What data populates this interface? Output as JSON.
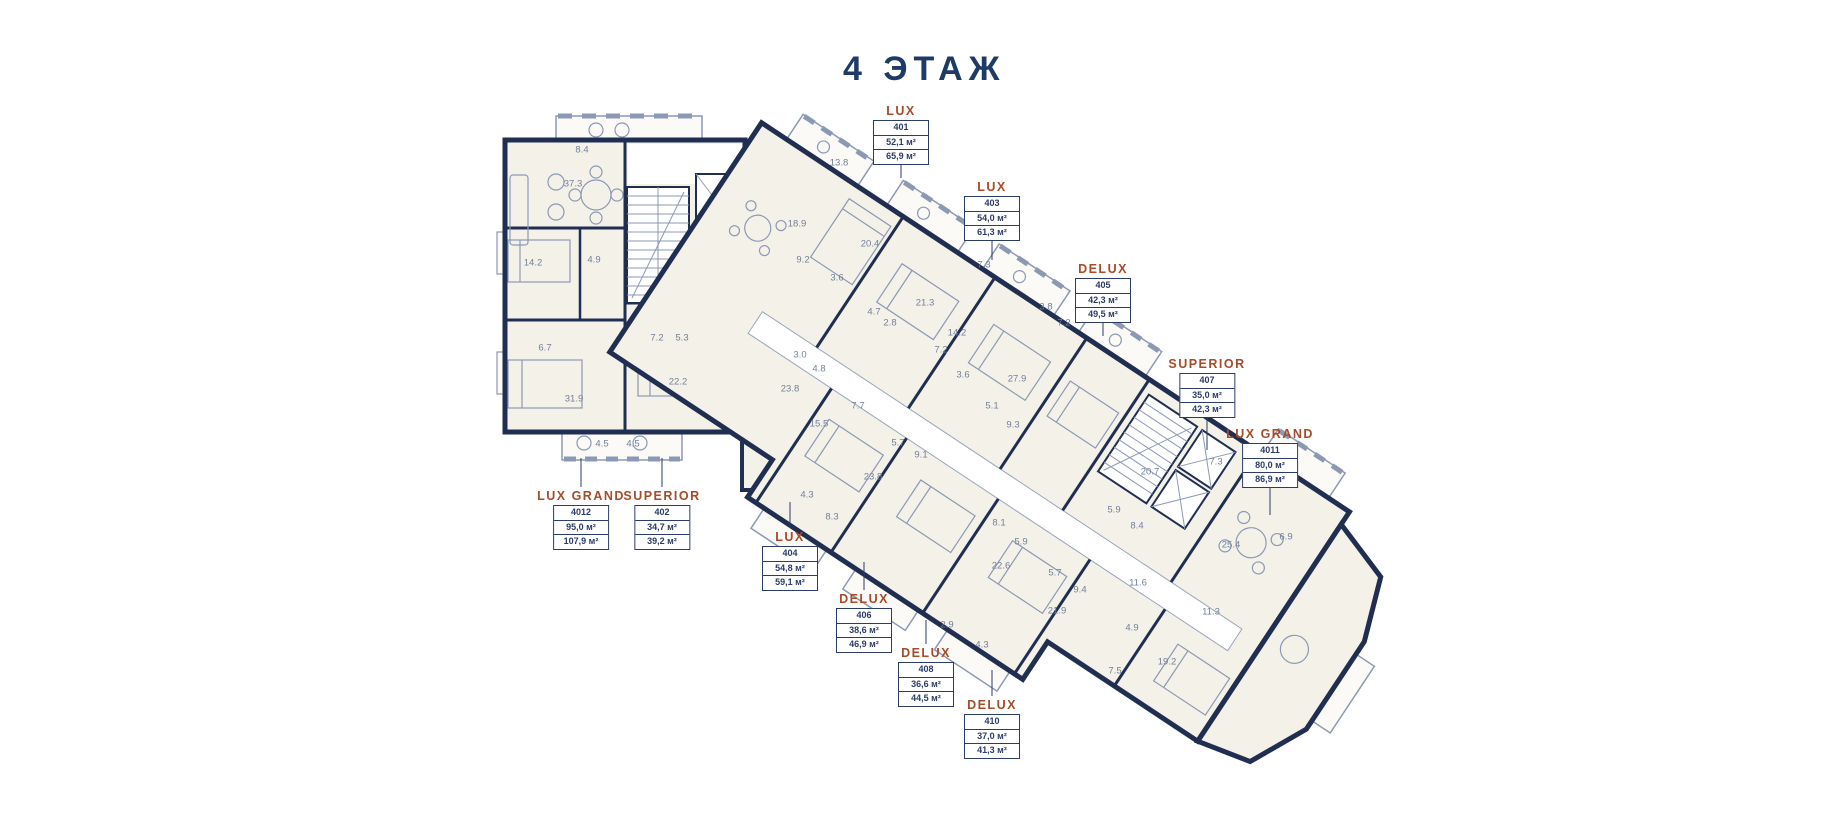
{
  "title": "4 ЭТАЖ",
  "colors": {
    "wall": "#202e52",
    "floor": "#f4f1e9",
    "corridor": "#ffffff",
    "furniture": "#8c99b5",
    "accent_unit_type": "#a74b28",
    "callout_text": "#2c3c68",
    "room_number_text": "#72809b",
    "title_text": "#1d3b66"
  },
  "units": [
    {
      "type": "LUX",
      "number": "401",
      "area1": "52,1 м²",
      "area2": "65,9 м²"
    },
    {
      "type": "LUX",
      "number": "403",
      "area1": "54,0 м²",
      "area2": "61,3 м²"
    },
    {
      "type": "DELUX",
      "number": "405",
      "area1": "42,3 м²",
      "area2": "49,5 м²"
    },
    {
      "type": "SUPERIOR",
      "number": "407",
      "area1": "35,0 м²",
      "area2": "42,3 м²"
    },
    {
      "type": "LUX GRAND",
      "number": "4011",
      "area1": "80,0 м²",
      "area2": "86,9 м²"
    },
    {
      "type": "LUX GRAND",
      "number": "4012",
      "area1": "95,0 м²",
      "area2": "107,9 м²"
    },
    {
      "type": "SUPERIOR",
      "number": "402",
      "area1": "34,7 м²",
      "area2": "39,2 м²"
    },
    {
      "type": "LUX",
      "number": "404",
      "area1": "54,8 м²",
      "area2": "59,1 м²"
    },
    {
      "type": "DELUX",
      "number": "406",
      "area1": "38,6 м²",
      "area2": "46,9 м²"
    },
    {
      "type": "DELUX",
      "number": "408",
      "area1": "36,6 м²",
      "area2": "44,5 м²"
    },
    {
      "type": "DELUX",
      "number": "410",
      "area1": "37,0 м²",
      "area2": "41,3 м²"
    }
  ],
  "rooms": [
    "8.4",
    "37.3",
    "14.2",
    "4.9",
    "6.7",
    "31.9",
    "7.2",
    "5.3",
    "22.2",
    "4.5",
    "4.5",
    "13.8",
    "18.9",
    "20.4",
    "9.2",
    "3.6",
    "21.3",
    "7.3",
    "4.7",
    "2.8",
    "14.2",
    "7.2",
    "3.6",
    "7.2",
    "3.8",
    "27.9",
    "5.1",
    "9.3",
    "5.7",
    "9.1",
    "3.0",
    "4.8",
    "23.8",
    "7.7",
    "15.5",
    "23.8",
    "4.3",
    "8.3",
    "8.1",
    "20.7",
    "7.3",
    "5.9",
    "8.4",
    "25.4",
    "6.9",
    "11.6",
    "11.3",
    "5.9",
    "22.6",
    "5.7",
    "9.4",
    "21.9",
    "4.9",
    "7.5",
    "19.2",
    "4.3",
    "2.9"
  ]
}
